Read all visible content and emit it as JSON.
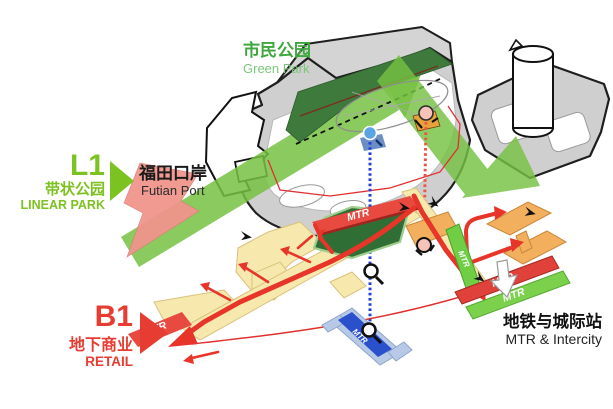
{
  "figure": {
    "type": "axonometric-level-diagram",
    "levels": [
      "L1",
      "B1"
    ]
  },
  "labels": {
    "green_park_zh": "市民公园",
    "green_park_en": "Green Park",
    "l1_code": "L1",
    "l1_zh": "带状公园",
    "l1_en": "LINEAR PARK",
    "futian_zh": "福田口岸",
    "futian_en": "Futian Port",
    "b1_code": "B1",
    "b1_zh": "地下商业",
    "b1_en": "RETAIL",
    "station_zh": "地铁与城际站",
    "station_en": "MTR & Intercity"
  },
  "mtr": {
    "west": "MTR",
    "north": "MTR",
    "link": "MTR",
    "se_red": "MTR",
    "se_green": "MTR",
    "platform": "MTR"
  },
  "colors": {
    "label_green": "#3ea83e",
    "label_green_light": "#7ac77a",
    "l1_accent_green": "#7cc220",
    "band_green": "#76c143",
    "dark_green": "#3e7a3c",
    "b1_dark_green": "#2f6e35",
    "label_red": "#e73c31",
    "route_red": "#e8352a",
    "salmon_arrow": "#f0958d",
    "retail_yellow": "#f7e9ae",
    "station_orange": "#f2b05e",
    "mtr_band_red": "#e84a40",
    "mtr_bar_green": "#7cd14c",
    "mtr_blue": "#2a50cc",
    "platform_blue": "#b7c9e6",
    "deck_gray": "#cfcfcf"
  }
}
